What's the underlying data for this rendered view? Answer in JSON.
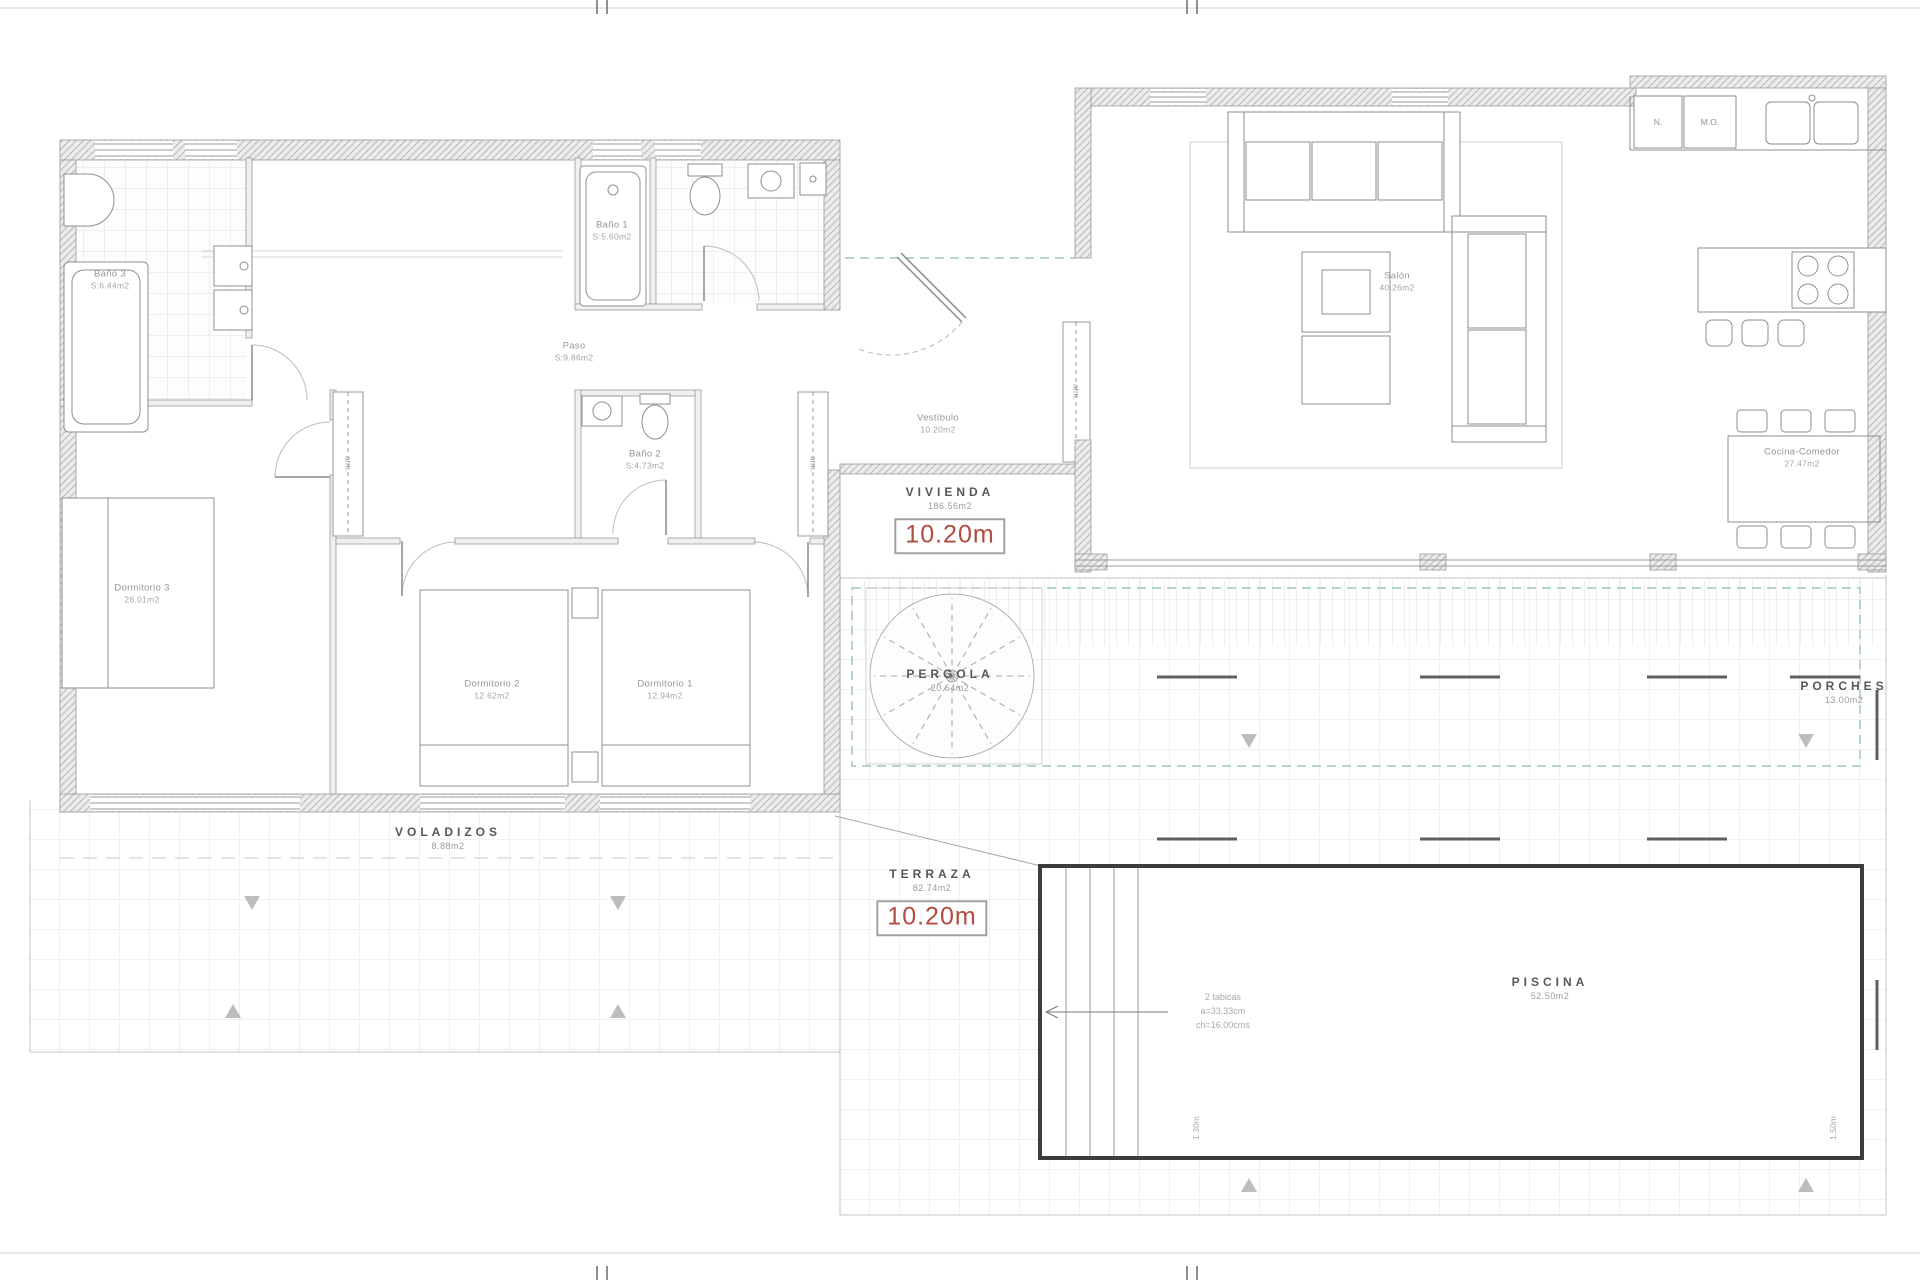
{
  "rooms": {
    "bano3": {
      "name": "Baño 3",
      "area": "S:6.44m2"
    },
    "bano1": {
      "name": "Baño 1",
      "area": "S:5.60m2"
    },
    "paso": {
      "name": "Paso",
      "area": "S:9.86m2"
    },
    "bano2": {
      "name": "Baño 2",
      "area": "S:4.73m2"
    },
    "dormitorio3": {
      "name": "Dormitorio 3",
      "area": "26.01m2"
    },
    "dormitorio2": {
      "name": "Dormitorio 2",
      "area": "12.62m2"
    },
    "dormitorio1": {
      "name": "Dormitorio 1",
      "area": "12.94m2"
    },
    "vestibulo": {
      "name": "Vestíbulo",
      "area": "10.20m2"
    },
    "salon": {
      "name": "Salón",
      "area": "40.26m2"
    },
    "cocina": {
      "name": "Cocina-Comedor",
      "area": "27.47m2"
    }
  },
  "zones": {
    "vivienda": {
      "name": "VIVIENDA",
      "area": "186.56m2",
      "height": "10.20m"
    },
    "terraza": {
      "name": "TERRAZA",
      "area": "82.74m2",
      "height": "10.20m"
    },
    "pergola": {
      "name": "PERGOLA",
      "area": "20.64m2"
    },
    "porches": {
      "name": "PORCHES",
      "area": "13.00m2"
    },
    "voladizos": {
      "name": "VOLADIZOS",
      "area": "8.88m2"
    },
    "piscina": {
      "name": "PISCINA",
      "area": "52.50m2"
    }
  },
  "annotations": {
    "pool_steps": {
      "l1": "2 tabicas",
      "l2": "a=33.33cm",
      "l3": "ch=16.00cms"
    },
    "pool_depth_left": "1.30m",
    "pool_depth_right": "1.50m",
    "appliance_fridge": "N.",
    "appliance_micro": "M.O.",
    "wardrobe": "arm."
  },
  "colors": {
    "dimension_red": "#b24b40",
    "pergola_dash_teal": "#9fc6c3",
    "pool_border": "#3c3c3c"
  }
}
